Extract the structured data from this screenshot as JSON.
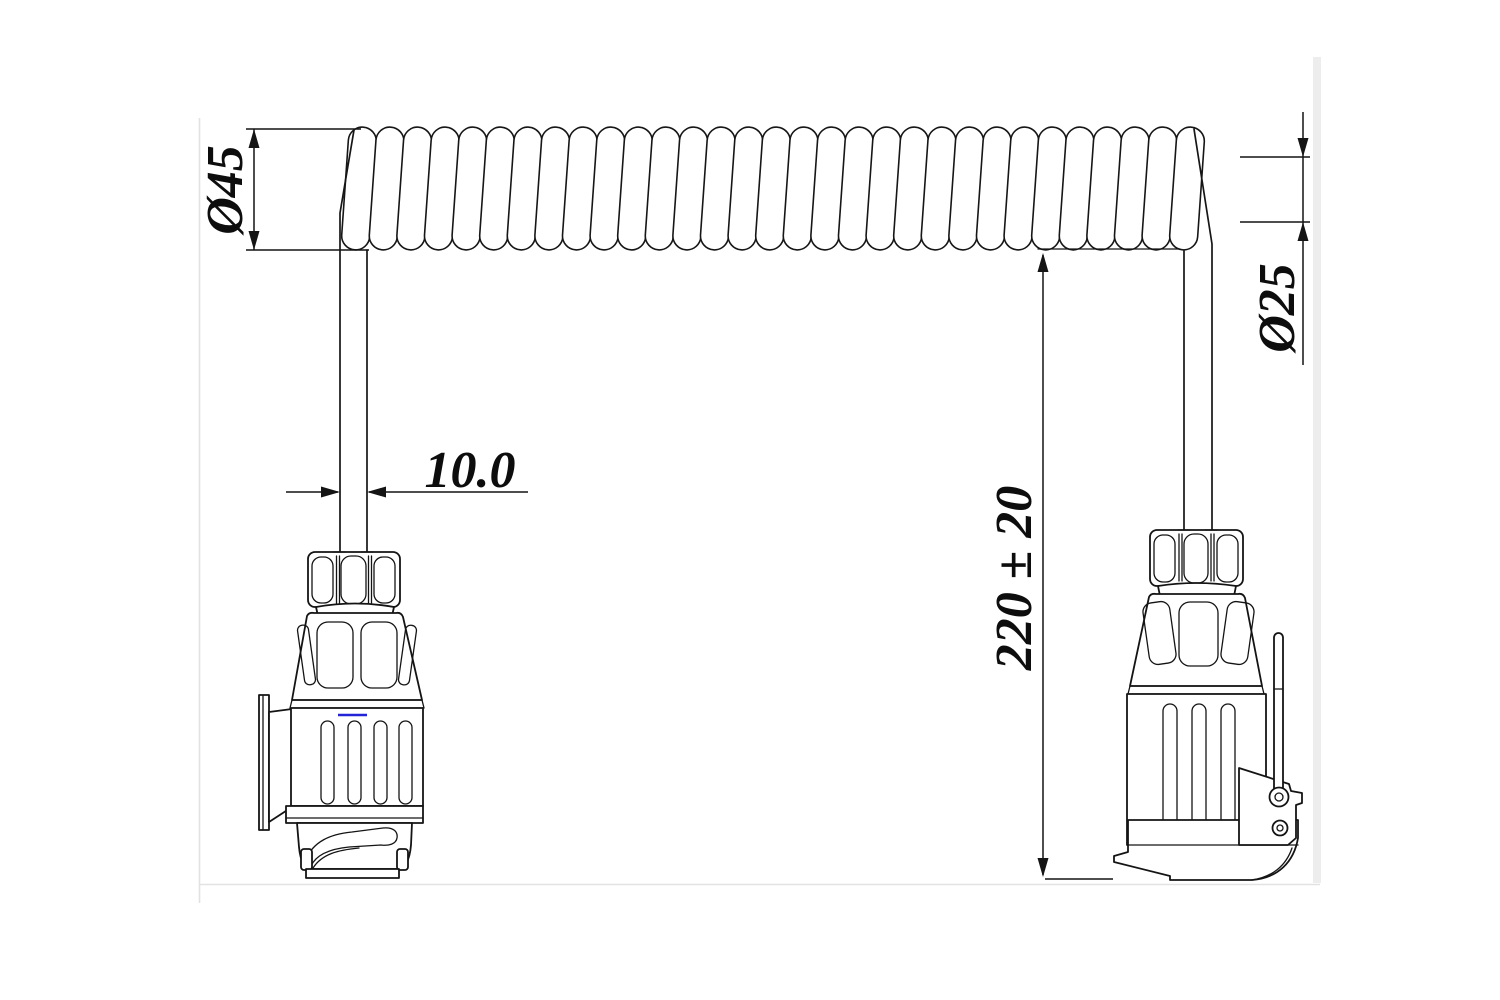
{
  "drawing": {
    "background": "#ffffff",
    "line_color": "#141414",
    "artifact_line_color": "#2323d7",
    "dimensions": {
      "coil_outer_diameter": "Ø45",
      "coil_inner_diameter": "Ø25",
      "cable_diameter": "10.0",
      "coiled_length": "220 ± 20"
    },
    "coil": {
      "loop_count": 31,
      "start_x": 359,
      "pitch": 27.6,
      "center_y": 188.5,
      "tilt_deg": 4,
      "loop_width": 28,
      "loop_height": 123
    }
  }
}
